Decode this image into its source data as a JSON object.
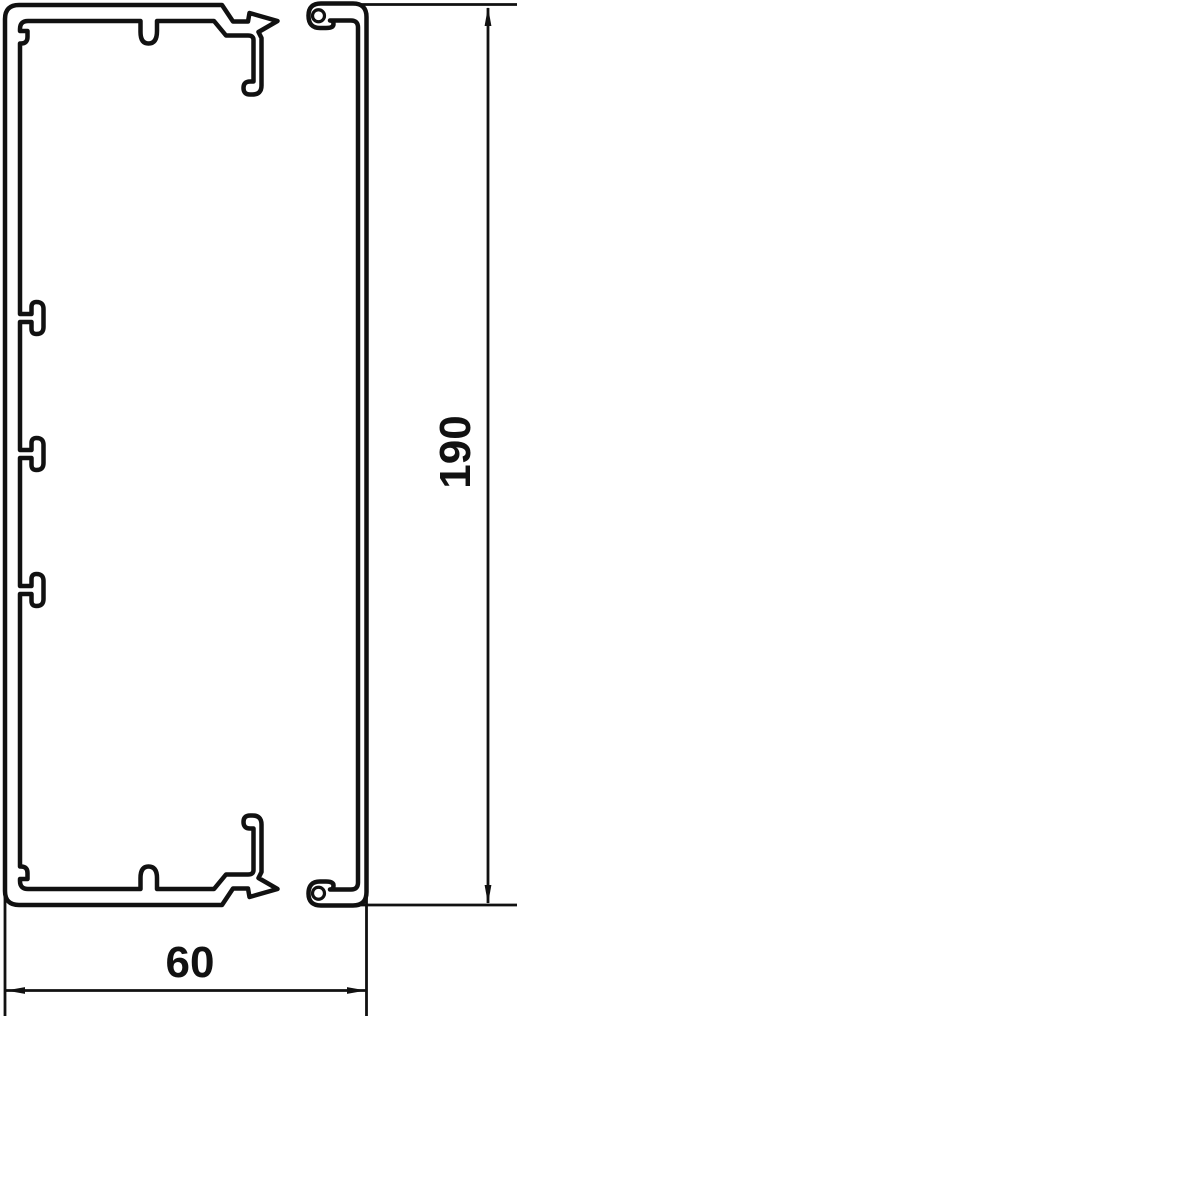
{
  "drawing": {
    "kind": "technical-cross-section",
    "dimension_labels": {
      "width": "60",
      "height": "190"
    },
    "colors": {
      "line": "#111111",
      "background": "#ffffff"
    }
  }
}
